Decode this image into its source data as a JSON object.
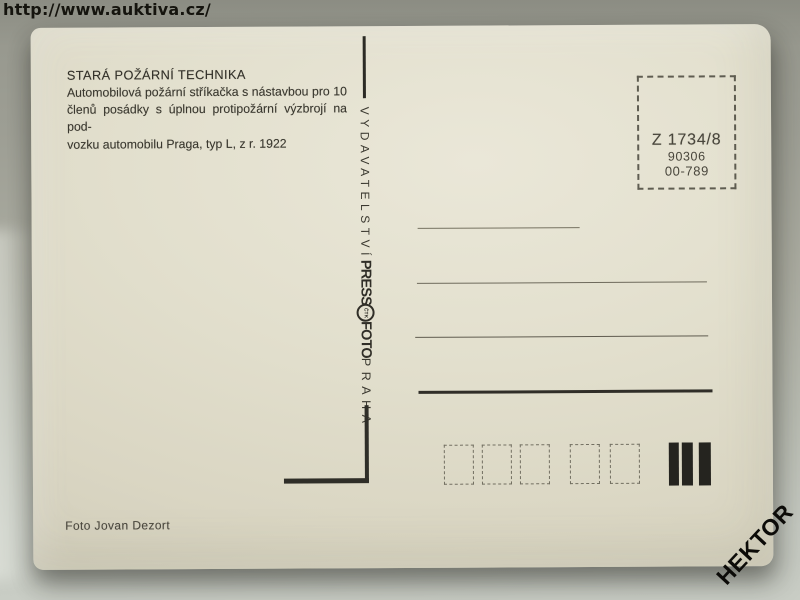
{
  "overlay": {
    "source_url": "http://www.auktiva.cz/",
    "seller_watermark": "HEKTOR"
  },
  "postcard": {
    "title": "STARÁ POŽÁRNÍ TECHNIKA",
    "description": [
      "Automobilová požární stříkačka s nástavbou pro 10",
      "členů posádky s úplnou protipožární výzbrojí na pod-",
      "vozku automobilu Praga, typ L, z r. 1922"
    ],
    "publisher_column": {
      "word_top": "VYDAVATELSTVÍ",
      "logo_press": "PRESS",
      "logo_emblem": "ČTK",
      "logo_foto": "FOTO",
      "word_bottom": "PRAHA"
    },
    "catalog_box": {
      "code": "Z 1734/8",
      "number": "90306",
      "order": "00-789"
    },
    "photo_credit": "Foto Jovan Dezort",
    "address_panel": {
      "line_count": 4,
      "postal_code_box_count": 5,
      "sorting_bar_count": 3
    }
  },
  "colors": {
    "background_top": "#95968c",
    "background_bottom": "#c9cdc5",
    "card_paper": "#e2dfcd",
    "print_ink": "#3a382f",
    "url_text": "#15140e"
  }
}
